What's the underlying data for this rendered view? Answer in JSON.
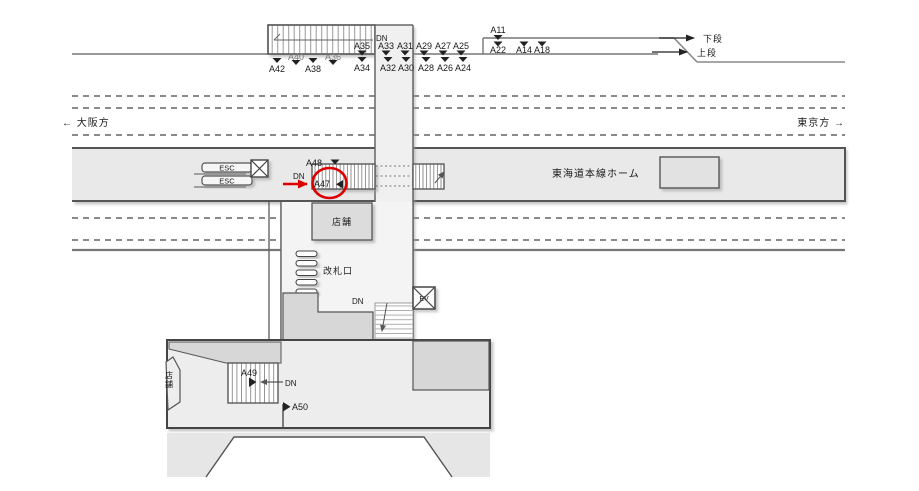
{
  "meta": {
    "description_note": "Station ad-location floor diagram with highlighted position"
  },
  "colors": {
    "accent_red": "#dd0000",
    "line": "#444",
    "platform_fill": "#e9e9e9",
    "block_fill": "#d7d7d7"
  },
  "top": {
    "dn": "DN",
    "upper_row": [
      "A35",
      "A33",
      "A31",
      "A29",
      "A27",
      "A25"
    ],
    "lower_row": [
      "A34",
      "A32",
      "A30",
      "A28",
      "A26",
      "A24"
    ],
    "left_upper": [
      "A40",
      "A36"
    ],
    "left_lower": [
      "A42",
      "A38"
    ],
    "a11": "A11",
    "right_lower": [
      "A22",
      "A14",
      "A18"
    ],
    "tier_lower": "下段",
    "tier_upper": "上段"
  },
  "directions": {
    "west": "←  大阪方",
    "east": "東京方  →"
  },
  "platform": {
    "esc_upper": "ESC",
    "esc_lower": "ESC",
    "dn": "DN",
    "label_a48": "A48",
    "highlight_label": "A47",
    "name": "東海道本線ホーム"
  },
  "concourse": {
    "shop": "店舗",
    "gate": "改札口",
    "dn": "DN",
    "ev": "EV"
  },
  "lower_level": {
    "label_a49": "A49",
    "dn": "DN",
    "label_a50": "A50",
    "shop": "店舗"
  }
}
